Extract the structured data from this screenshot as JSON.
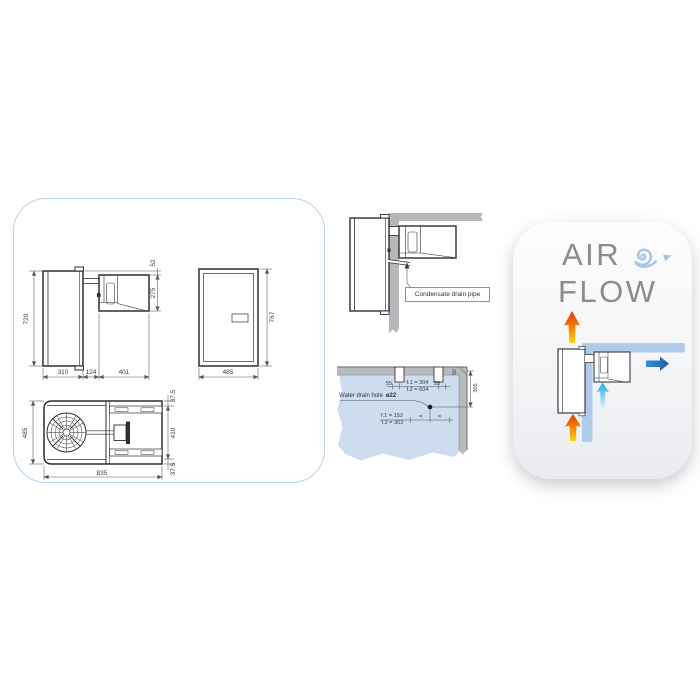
{
  "colors": {
    "panel_border": "#b9d3ea",
    "drawing_line": "#2f2f31",
    "dimension_line": "#55555b",
    "wall_gray": "#b4b8bb",
    "wall_blue_fill": "#cddcee",
    "airflow_wall_blue": "#aecbe9",
    "hot_air_yellow": "#ffd400",
    "hot_air_red": "#e8380d",
    "cold_air_cyan": "#29abe2",
    "air_out_blue": "#1c6fb4",
    "title_gray": "#8a8c8f",
    "swirl_blue": "#a5c6e8"
  },
  "left_panel": {
    "side_view": {
      "dim_height": "720",
      "dim_top_offset": "52",
      "dim_unit_height": "275",
      "dim_depth_inside": "310",
      "dim_wall_thickness": "124",
      "dim_depth_outside": "401"
    },
    "front_view": {
      "dim_height": "767",
      "dim_width": "485"
    },
    "top_view": {
      "dim_width": "485",
      "dim_side_margin_top": "37.5",
      "dim_body_width": "410",
      "dim_side_margin_bottom": "37.5",
      "dim_length": "835"
    }
  },
  "installation": {
    "condensate_label": "Condensate drain pipe",
    "water_drain": {
      "label": "Water drain hole",
      "diameter": "ø22",
      "slot_offset_left": "55",
      "slot_pitch_f1": "f.1 = 304",
      "slot_pitch_f2": "f.2 = 604",
      "slot_offset_right": "55",
      "corner_offset": "50",
      "hole_depth": "305",
      "hole_offset_f1": "f.1 = 152",
      "hole_offset_f2": "f.2 = 302",
      "equal_left": "=",
      "equal_right": "="
    }
  },
  "airflow_panel": {
    "title_line1": "AIR",
    "title_line2": "FLOW"
  }
}
